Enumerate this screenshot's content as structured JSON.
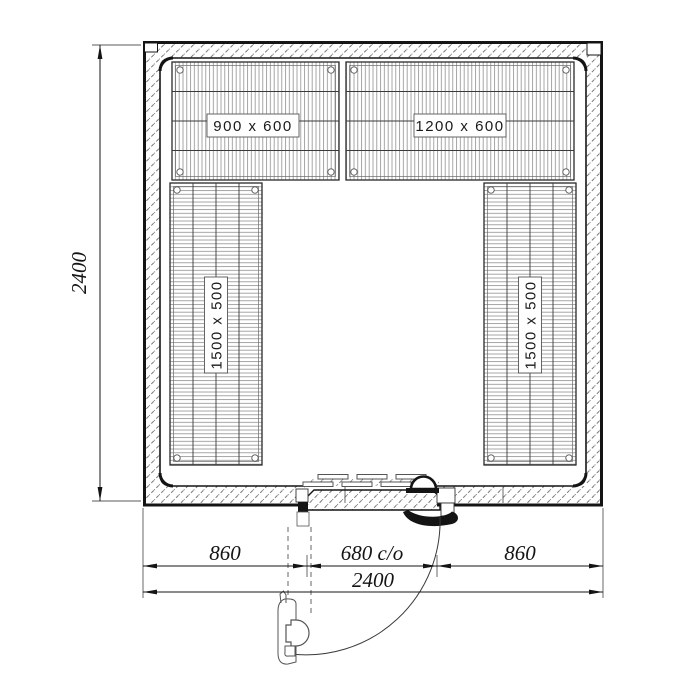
{
  "drawing": {
    "kind": "cold-room-floor-plan"
  },
  "labels": {
    "shelf_top_left": "900 x 600",
    "shelf_top_right": "1200 x 600",
    "shelf_left": "1500 x 500",
    "shelf_right": "1500 x 500"
  },
  "dimensions": {
    "overall_height": "2400",
    "overall_width": "2400",
    "left_of_door": "860",
    "door_opening": "680 c/o",
    "right_of_door": "860"
  },
  "colors": {
    "line": "#141414",
    "hatch": "#666666",
    "wire": "#8f8f8f",
    "background": "#ffffff"
  }
}
